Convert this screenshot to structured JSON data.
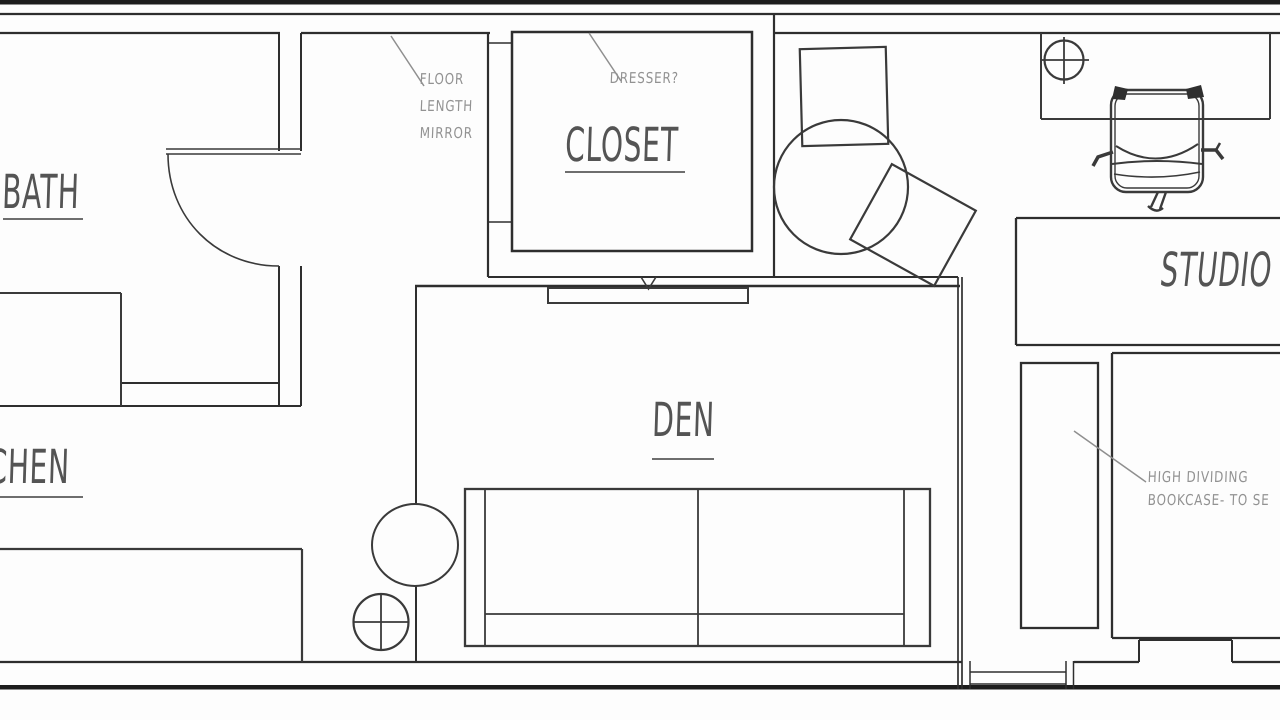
{
  "title": "Apartment floor plan sketch",
  "colors": {
    "background": "#fdfdfd",
    "wall": "#2e2e2e",
    "outer_wall": "#1d1d1d",
    "room_label": "#545454",
    "annotation": "#929292",
    "leader_line": "#8f8f8f"
  },
  "rooms": {
    "bath": {
      "label": "BATH"
    },
    "kitchen": {
      "label": "KITCHEN"
    },
    "closet": {
      "label": "CLOSET"
    },
    "den": {
      "label": "DEN"
    },
    "studio": {
      "label": "STUDIO"
    }
  },
  "annotations": {
    "mirror": {
      "line1": "FLOOR",
      "line2": "LENGTH",
      "line3": "MIRROR"
    },
    "dresser": {
      "label": "DRESSER?"
    },
    "bookcase": {
      "line1": "HIGH DIVIDING",
      "line2": "BOOKCASE- TO SE"
    }
  },
  "furniture": {
    "den": [
      "sofa",
      "round-side-table",
      "floor-lamp",
      "tv-console"
    ],
    "nook": [
      "side-chair",
      "round-table",
      "tilted-chair"
    ],
    "desk_area": [
      "desk",
      "desk-lamp",
      "office-chair"
    ],
    "studio": [
      "worktable",
      "high-dividing-bookcase",
      "bed"
    ],
    "bath": [
      "vanity-counter",
      "door-swing"
    ],
    "kitchen": [
      "counter"
    ],
    "openings": [
      "bath-door",
      "bottom-window"
    ]
  }
}
